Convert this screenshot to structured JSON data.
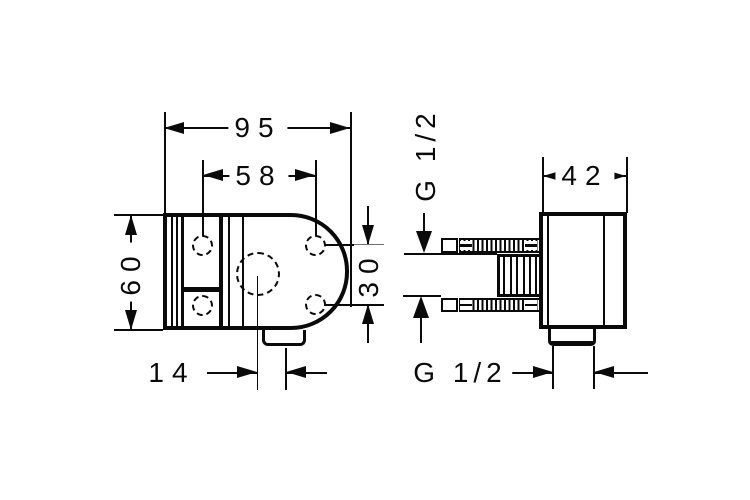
{
  "drawing": {
    "type": "technical-dimension-drawing",
    "background_color": "#ffffff",
    "line_color": "#0a0a0a",
    "front_view": {
      "dim_overall_width_mm": "95",
      "dim_hole_spacing_horizontal_mm": "58",
      "dim_overall_height_mm": "60",
      "dim_hole_spacing_vertical_mm": "30",
      "dim_outlet_offset_mm": "14"
    },
    "side_view": {
      "dim_depth_mm": "42",
      "thread_label_top": "G 1/2",
      "thread_label_bottom": "G 1/2"
    }
  }
}
